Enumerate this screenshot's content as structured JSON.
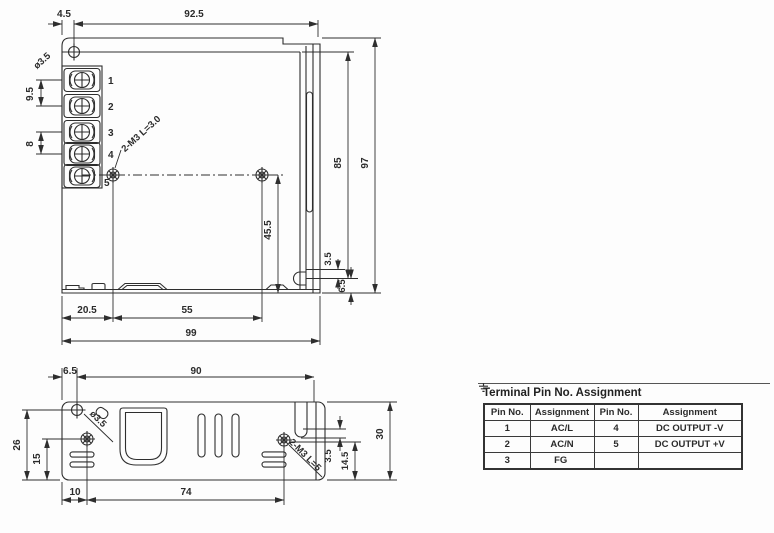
{
  "drawing": {
    "top_view": {
      "dim_4_5": "4.5",
      "dim_92_5": "92.5",
      "hole_label": "ø3.5",
      "dim_9_5": "9.5",
      "dim_8": "8",
      "thread_label": "2-M3 L=3.0",
      "dim_85": "85",
      "dim_97": "97",
      "dim_45_5": "45.5",
      "dim_3_5": "3.5",
      "dim_6_5": "6.5",
      "dim_20_5": "20.5",
      "dim_55": "55",
      "dim_99": "99",
      "terminal_numbers": [
        "1",
        "2",
        "3",
        "4",
        "5"
      ]
    },
    "bottom_view": {
      "dim_6_5": "6.5",
      "dim_90": "90",
      "hole_label": "ø3.5",
      "dim_26": "26",
      "dim_15": "15",
      "dim_10": "10",
      "dim_74": "74",
      "thread_label": "2-M3 L=5",
      "dim_3_5": "3.5",
      "dim_14_5": "14.5",
      "dim_30": "30"
    }
  },
  "pin_table": {
    "title": "Terminal Pin No.  Assignment",
    "headers": [
      "Pin No.",
      "Assignment",
      "Pin No.",
      "Assignment"
    ],
    "rows": [
      {
        "cells": [
          "1",
          "AC/L",
          "4",
          "DC OUTPUT -V"
        ]
      },
      {
        "cells": [
          "2",
          "AC/N",
          "5",
          "DC OUTPUT +V"
        ]
      },
      {
        "cells": [
          "3",
          "FG",
          "",
          ""
        ],
        "ground_icon_cell": 1
      }
    ]
  },
  "colors": {
    "line": "#2e2e2e",
    "background": "#fdfdfd"
  }
}
